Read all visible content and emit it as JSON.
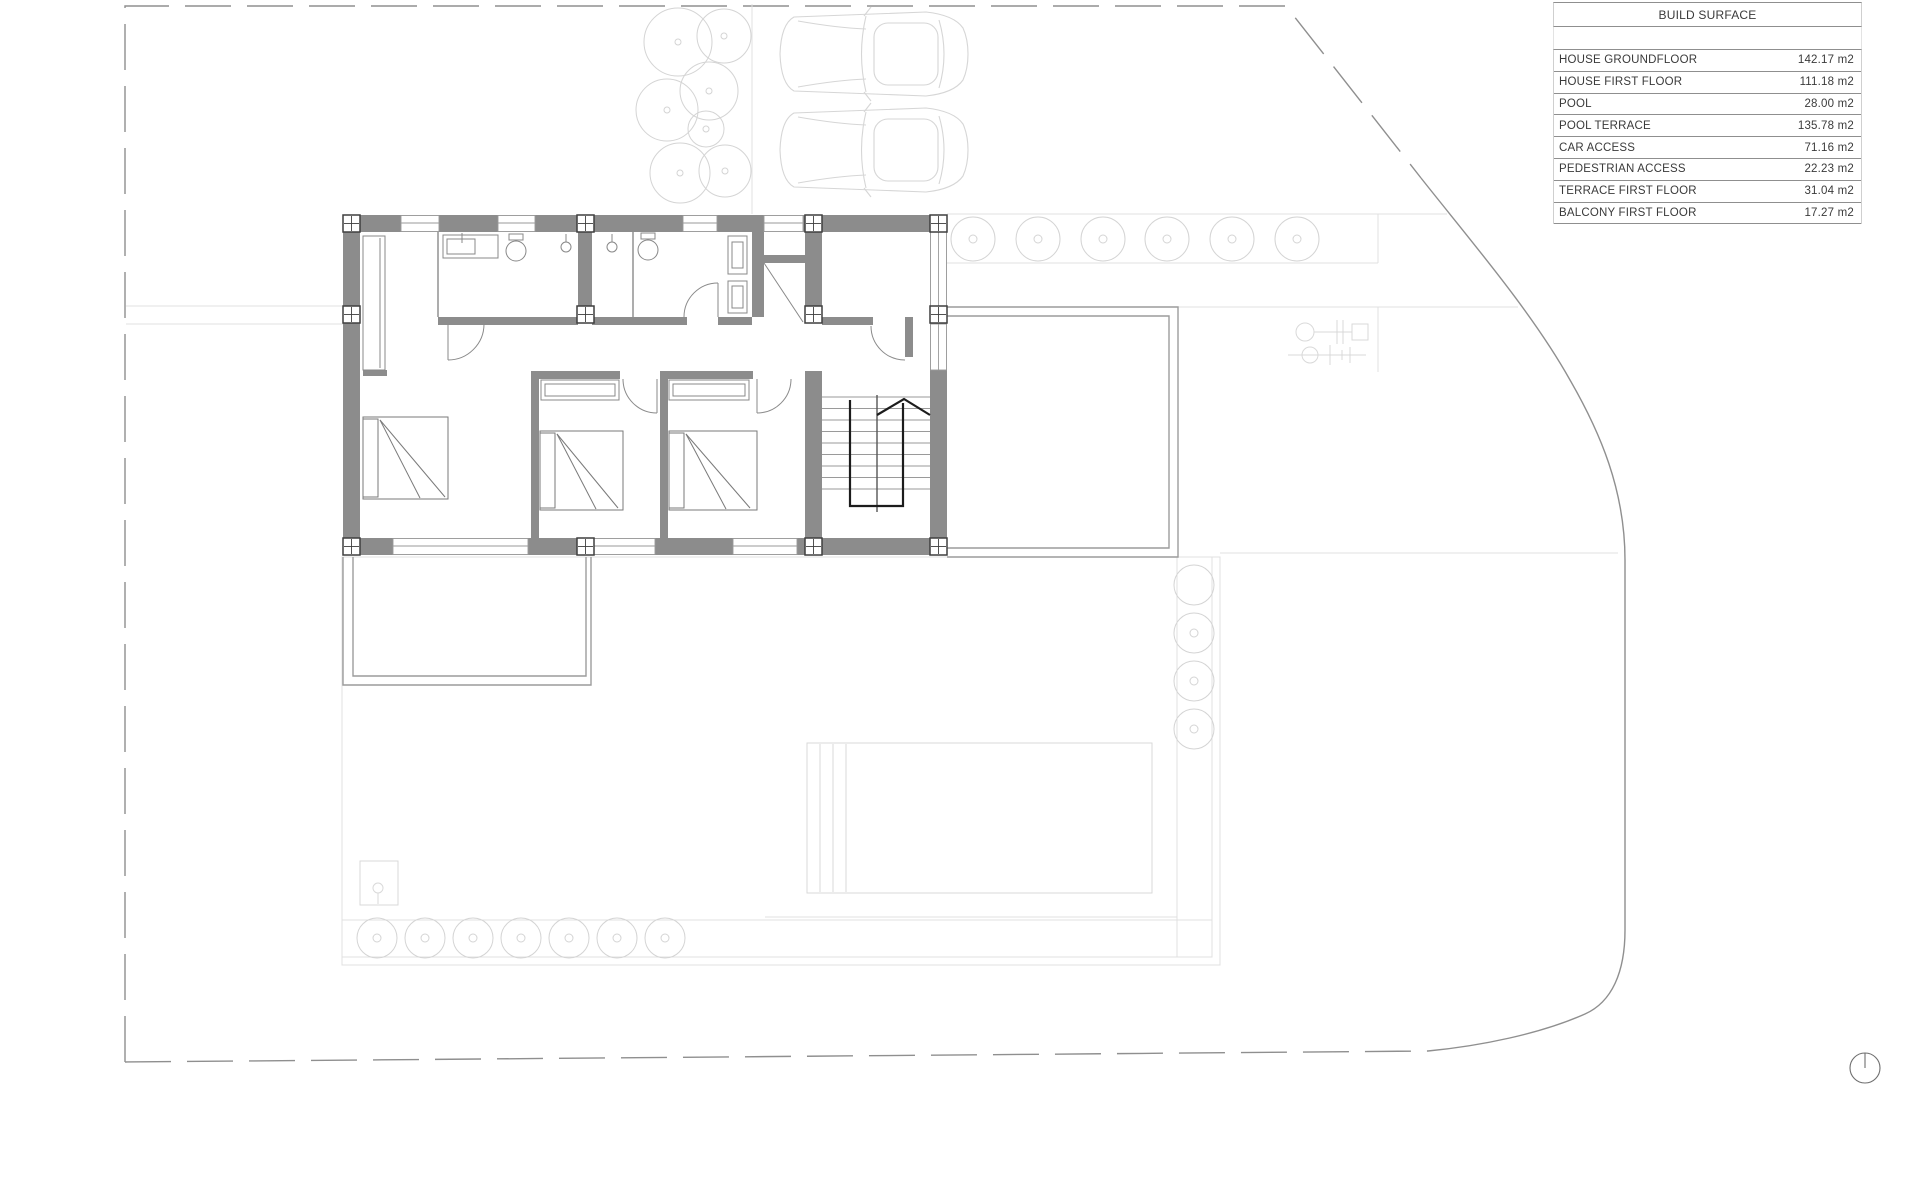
{
  "build_surface_table": {
    "header": "BUILD SURFACE",
    "rows": [
      {
        "label": "HOUSE GROUNDFLOOR",
        "value": "142.17 m2"
      },
      {
        "label": "HOUSE FIRST FLOOR",
        "value": "111.18 m2"
      },
      {
        "label": "POOL",
        "value": "28.00 m2"
      },
      {
        "label": "POOL TERRACE",
        "value": "135.78 m2"
      },
      {
        "label": "CAR ACCESS",
        "value": "71.16 m2"
      },
      {
        "label": "PEDESTRIAN ACCESS",
        "value": "22.23 m2"
      },
      {
        "label": "TERRACE FIRST FLOOR",
        "value": "31.04 m2"
      },
      {
        "label": "BALCONY FIRST FLOOR",
        "value": "17.27 m2"
      }
    ]
  },
  "icons": {
    "tree": "circle-with-center-dot",
    "car": "car-top-view-outline",
    "column": "four-pane-square",
    "stairs_direction": "up-arrow-chevron",
    "north_indicator": "circle-with-vertical-radius"
  },
  "colors": {
    "wall_gray": "#8c8c8c",
    "boundary_gray": "#8f8f8f",
    "terrace_gray": "#9c9c9c",
    "site_faint_gray": "#e0e0e0",
    "tree_gray": "#d4d4d4",
    "stair_rail_black": "#1c1c1c",
    "table_text": "#3a3a3a",
    "background": "#ffffff"
  }
}
